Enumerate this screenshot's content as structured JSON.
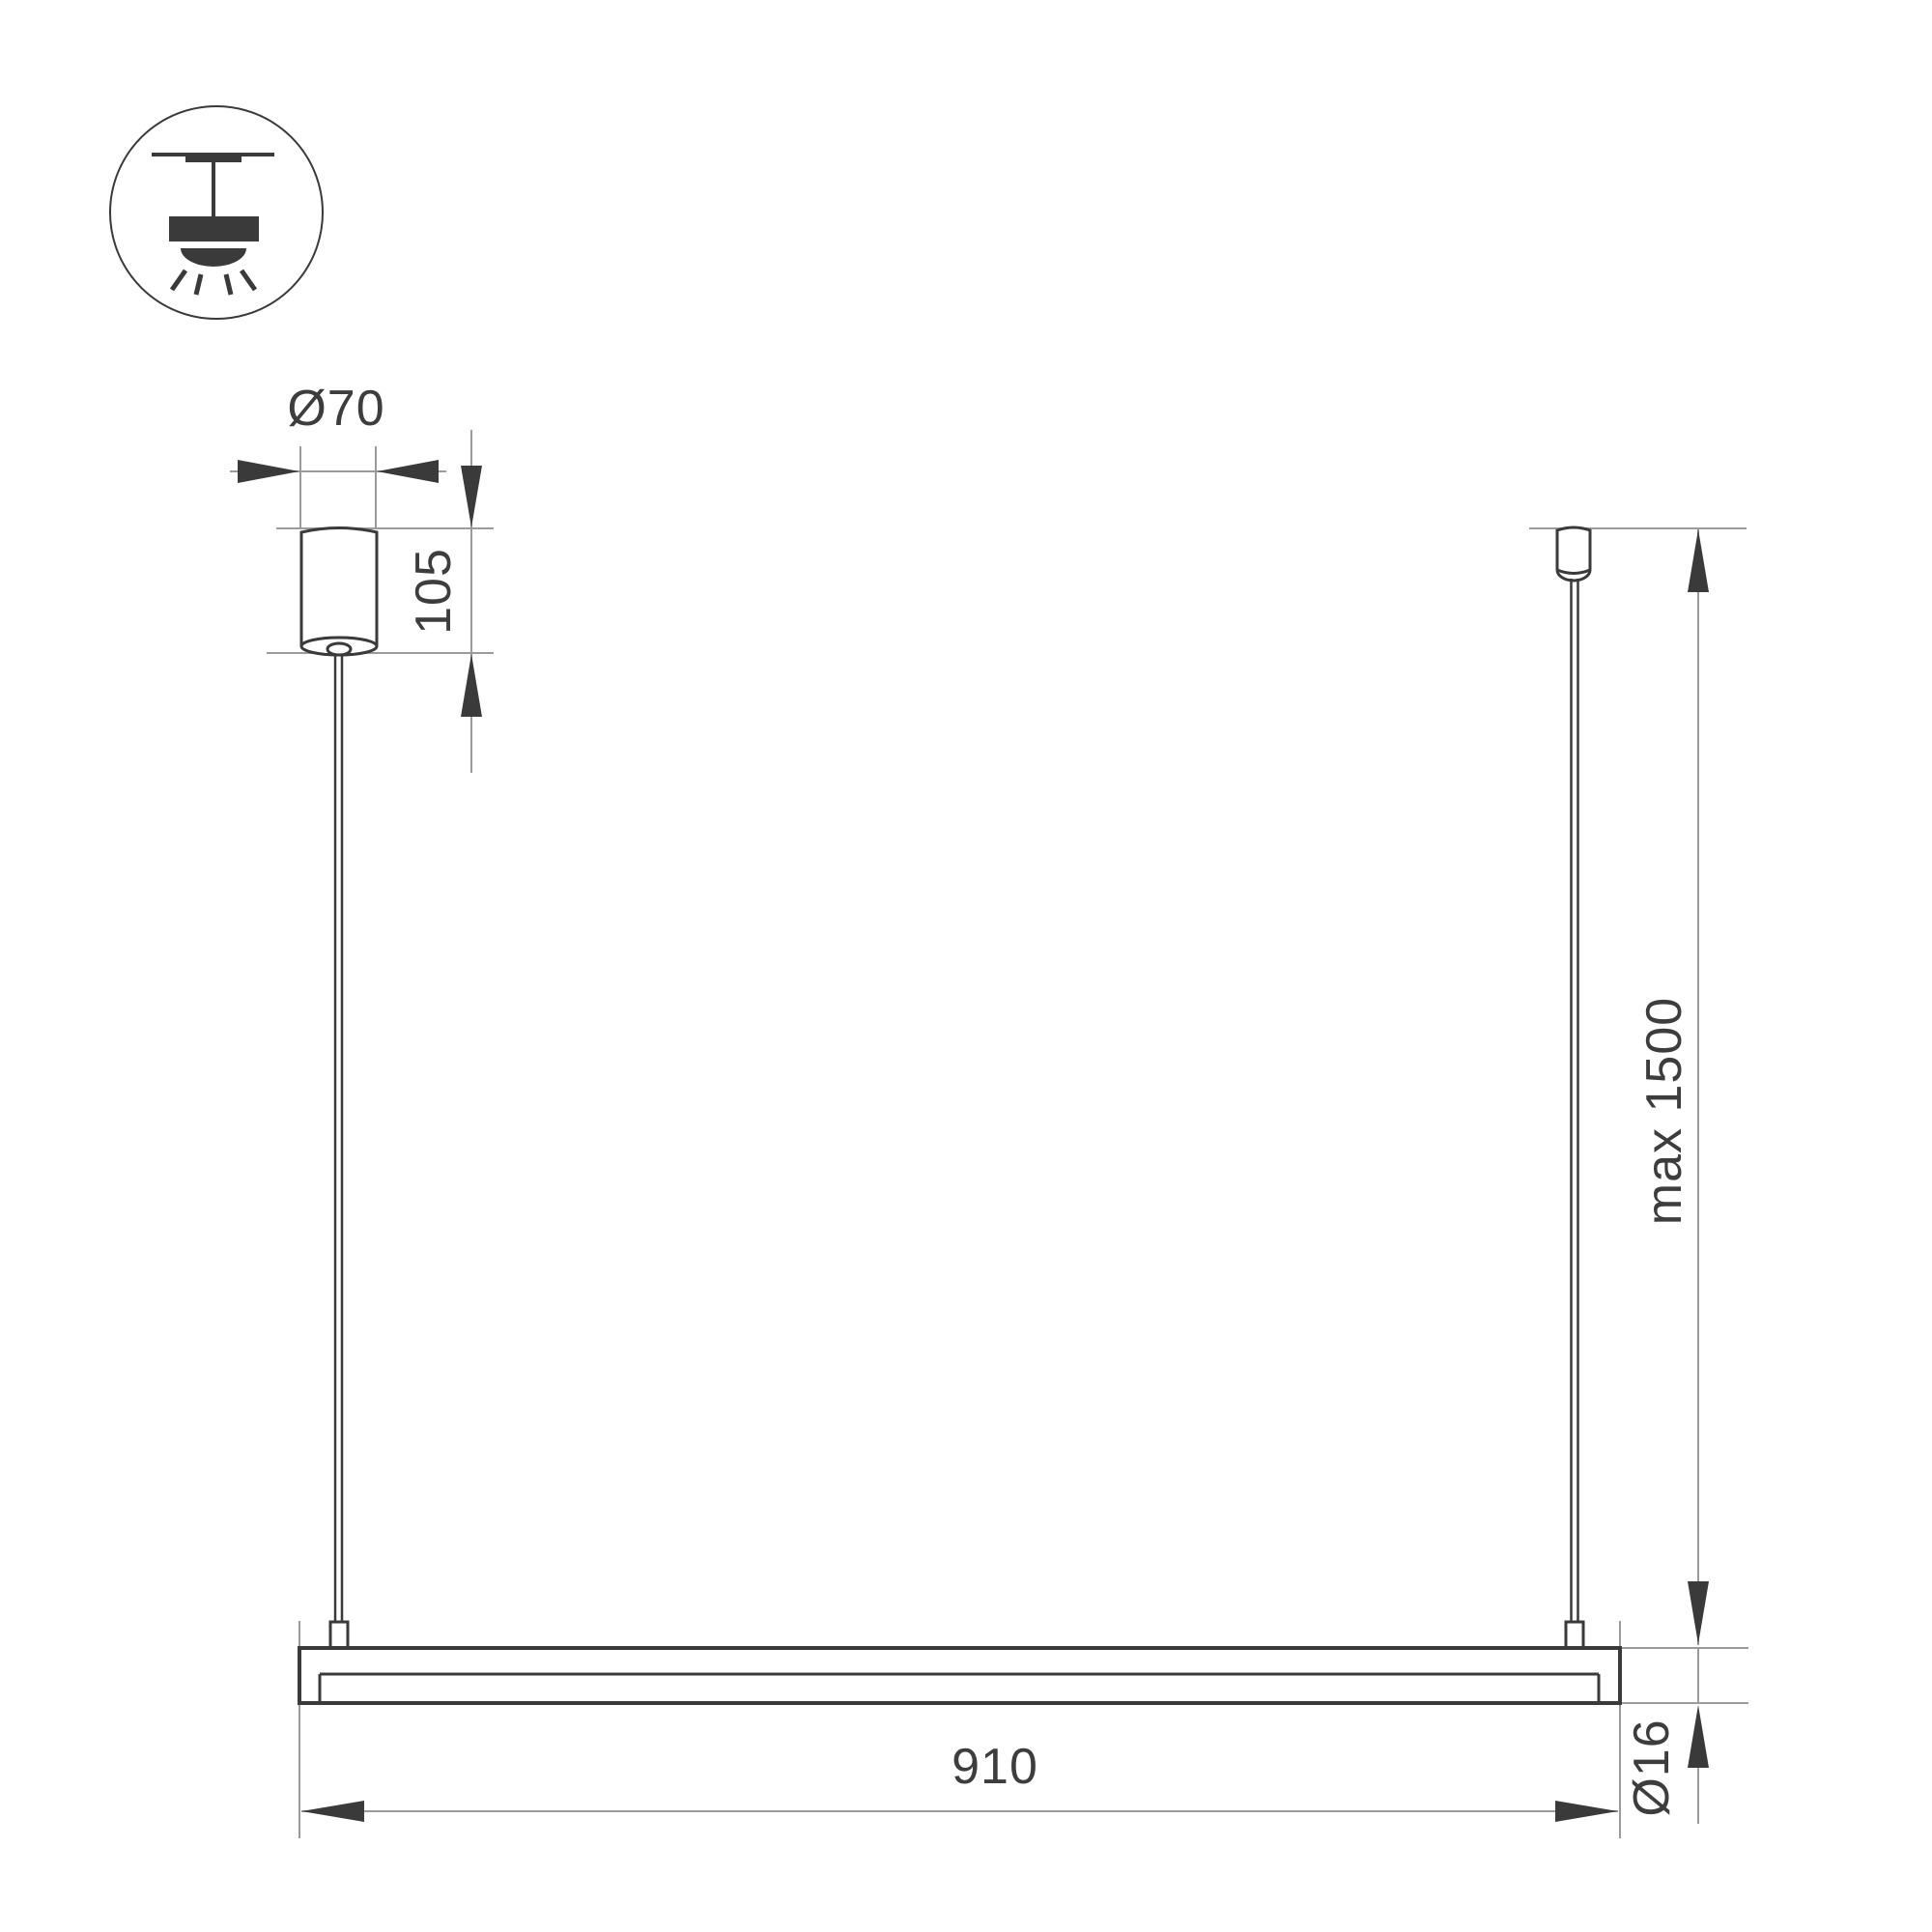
{
  "drawing": {
    "type": "technical-dimension-drawing",
    "subject": "linear-pendant-light",
    "labels": {
      "canopy_diameter": "Ø70",
      "canopy_height": "105",
      "suspension_length": "max 1500",
      "bar_length": "910",
      "bar_diameter": "Ø16"
    },
    "icon": {
      "name": "ceiling-pendant-mount-icon"
    },
    "colors": {
      "outline": "#3a3a3a",
      "dimension": "#9b9b9b",
      "text": "#3d3d3d",
      "background": "#ffffff"
    }
  }
}
